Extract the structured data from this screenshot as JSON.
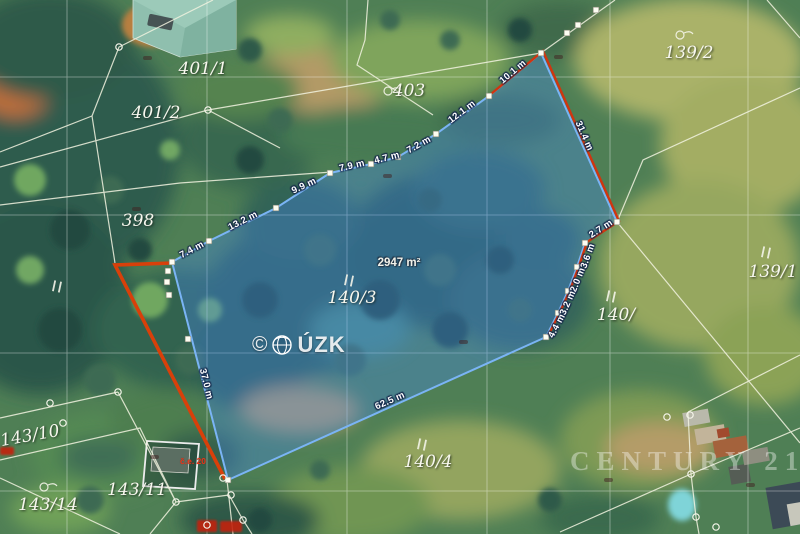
{
  "map": {
    "title": "Aerial cadastral map with highlighted parcel",
    "watermarks": {
      "cuzk_copyright": "©",
      "cuzk_text": "ÚZK",
      "century21": "CENTURY 21"
    },
    "colors": {
      "highlight_fill": "#4688eb",
      "highlight_stroke": "#7ab4f5",
      "red_boundary": "#d03510",
      "boundary_white": "#f2f3e0"
    },
    "area_label": {
      "text": "2947 m²",
      "x": 399,
      "y": 263
    },
    "parcel_labels": [
      {
        "text": "401/1",
        "x": 203,
        "y": 69
      },
      {
        "text": "401/2",
        "x": 156,
        "y": 113
      },
      {
        "text": "398",
        "x": 138,
        "y": 221
      },
      {
        "text": "403",
        "x": 409,
        "y": 91
      },
      {
        "text": "139/2",
        "x": 689,
        "y": 53
      },
      {
        "text": "139/1",
        "x": 773,
        "y": 272
      },
      {
        "text": "140/",
        "x": 616,
        "y": 315
      },
      {
        "text": "140/3",
        "x": 352,
        "y": 298
      },
      {
        "text": "140/4",
        "x": 428,
        "y": 462
      },
      {
        "text": "143/10",
        "x": 30,
        "y": 436,
        "rot": -10
      },
      {
        "text": "143/11",
        "x": 137,
        "y": 490
      },
      {
        "text": "143/14",
        "x": 48,
        "y": 505
      }
    ],
    "measurement_labels": [
      {
        "text": "7.4 m",
        "x": 192,
        "y": 250,
        "rot": -28
      },
      {
        "text": "13.2 m",
        "x": 243,
        "y": 221,
        "rot": -27
      },
      {
        "text": "9.9 m",
        "x": 304,
        "y": 186,
        "rot": -25
      },
      {
        "text": "7.9 m",
        "x": 352,
        "y": 166,
        "rot": -13
      },
      {
        "text": "4.7 m",
        "x": 387,
        "y": 158,
        "rot": -14
      },
      {
        "text": "7.2 m",
        "x": 419,
        "y": 145,
        "rot": -29
      },
      {
        "text": "12.1 m",
        "x": 462,
        "y": 112,
        "rot": -37
      },
      {
        "text": "10.1 m",
        "x": 513,
        "y": 72,
        "rot": -40
      },
      {
        "text": "31.4 m",
        "x": 584,
        "y": 136,
        "rot": 66
      },
      {
        "text": "2.7 m",
        "x": 601,
        "y": 229,
        "rot": -33
      },
      {
        "text": "3.6 m",
        "x": 588,
        "y": 256,
        "rot": -70
      },
      {
        "text": "2.0 m",
        "x": 578,
        "y": 280,
        "rot": -68
      },
      {
        "text": "3.2 m",
        "x": 568,
        "y": 303,
        "rot": -66
      },
      {
        "text": "4.4 m",
        "x": 557,
        "y": 326,
        "rot": -62
      },
      {
        "text": "62.5 m",
        "x": 390,
        "y": 401,
        "rot": -24
      },
      {
        "text": "37.0 m",
        "x": 206,
        "y": 384,
        "rot": 76
      }
    ],
    "red_labels": [
      {
        "text": "č.e. 20",
        "x": 193,
        "y": 461
      }
    ],
    "vertex_squares": [
      [
        172,
        262
      ],
      [
        209,
        241
      ],
      [
        276,
        208
      ],
      [
        330,
        173
      ],
      [
        371,
        164
      ],
      [
        398,
        157
      ],
      [
        436,
        134
      ],
      [
        489,
        96
      ],
      [
        541,
        53
      ],
      [
        617,
        222
      ],
      [
        585,
        243
      ],
      [
        577,
        267
      ],
      [
        568,
        291
      ],
      [
        558,
        313
      ],
      [
        546,
        337
      ],
      [
        228,
        480
      ],
      [
        168,
        271
      ],
      [
        167,
        282
      ],
      [
        169,
        295
      ],
      [
        188,
        339
      ],
      [
        567,
        33
      ],
      [
        578,
        25
      ],
      [
        596,
        10
      ]
    ],
    "vertex_circles": [
      [
        223,
        478
      ],
      [
        231,
        495
      ],
      [
        243,
        520
      ],
      [
        176,
        502
      ],
      [
        207,
        525
      ],
      [
        50,
        403
      ],
      [
        63,
        423
      ],
      [
        118,
        392
      ],
      [
        667,
        417
      ],
      [
        690,
        415
      ],
      [
        691,
        474
      ],
      [
        696,
        517
      ],
      [
        716,
        527
      ],
      [
        119,
        47
      ],
      [
        208,
        110
      ]
    ]
  }
}
